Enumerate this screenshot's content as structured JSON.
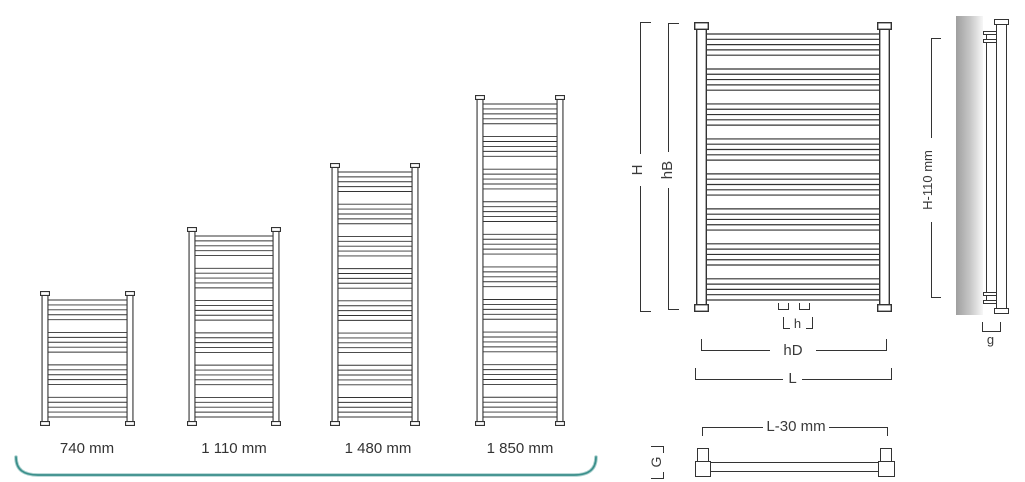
{
  "colors": {
    "line": "#333333",
    "text": "#3a3a3a",
    "teal": "#3a8f8b",
    "teal_light": "#a9cfcd",
    "wall": "#a6a6a6"
  },
  "size_chart": {
    "items": [
      {
        "label": "740 mm"
      },
      {
        "label": "1 110 mm"
      },
      {
        "label": "1 480 mm"
      },
      {
        "label": "1 850 mm"
      }
    ]
  },
  "drawings": {
    "lines_per_group": 5,
    "size_740": {
      "groups": 4
    },
    "size_1110": {
      "groups": 6
    },
    "size_1480": {
      "groups": 8
    },
    "size_1850": {
      "groups": 10
    },
    "front_view": {
      "groups": 8
    }
  },
  "dimensions": {
    "overall_height": "H",
    "tube_bank_height": "hB",
    "connection_spacing": "h",
    "connection_width": "hD",
    "overall_width": "L",
    "bracket_height": "H-110 mm",
    "wall_gap": "g",
    "bracket_width": "L-30 mm",
    "depth": "G"
  }
}
